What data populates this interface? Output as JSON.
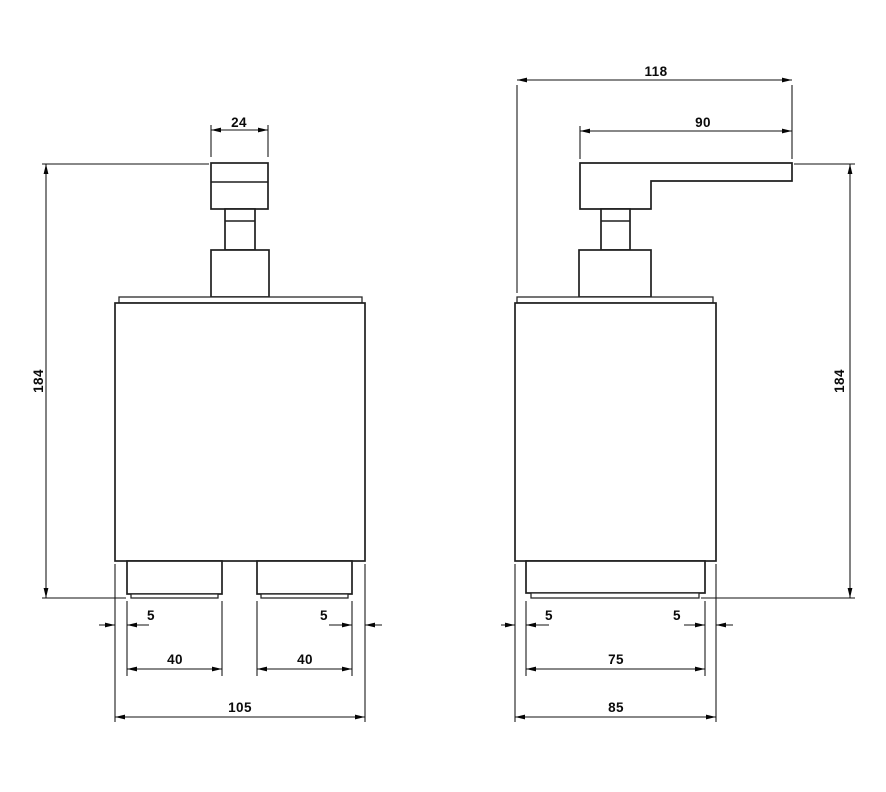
{
  "drawing": {
    "description": "Two-view dimensioned technical drawing of a pump soap dispenser",
    "colors": {
      "background": "#ffffff",
      "object_line": "#1f1f1f",
      "dimension_line": "#111111",
      "text": "#0a0a0a"
    },
    "front_view": {
      "dim_pump_cap_width": "24",
      "dim_overall_height": "184",
      "dim_foot_inset_left": "5",
      "dim_foot_inset_right": "5",
      "dim_foot_width_left": "40",
      "dim_foot_width_right": "40",
      "dim_overall_width": "105"
    },
    "side_view": {
      "dim_overall_depth": "118",
      "dim_spout_reach": "90",
      "dim_overall_height": "184",
      "dim_foot_inset_front": "5",
      "dim_foot_inset_back": "5",
      "dim_foot_depth": "75",
      "dim_body_depth": "85"
    }
  }
}
